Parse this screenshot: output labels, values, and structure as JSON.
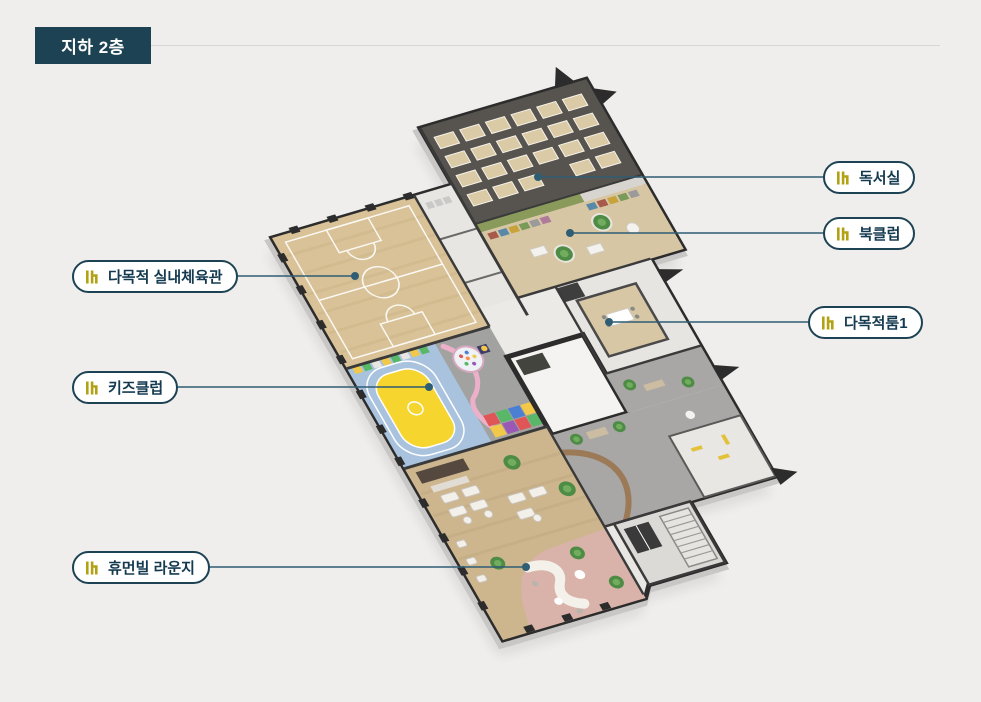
{
  "header": {
    "floor_badge": "지하 2층",
    "badge_color": "#1d4253"
  },
  "floorplan": {
    "type": "isometric-3d-floor-plan",
    "floor": "지하 2층",
    "callouts": [
      {
        "id": "reading-room",
        "label": "독서실",
        "side": "right"
      },
      {
        "id": "book-club",
        "label": "북클럽",
        "side": "right"
      },
      {
        "id": "multipurpose-gym",
        "label": "다목적 실내체육관",
        "side": "left"
      },
      {
        "id": "multipurpose-room-1",
        "label": "다목적룸1",
        "side": "right"
      },
      {
        "id": "kids-club",
        "label": "키즈클럽",
        "side": "left"
      },
      {
        "id": "humanville-lounge",
        "label": "휴먼빌 라운지",
        "side": "left"
      }
    ],
    "unlabeled_areas": [
      {
        "id": "lobby-corridor",
        "floor_color": "#a8a7a5"
      },
      {
        "id": "elevator-core",
        "floor_color": "#f4f3f1"
      },
      {
        "id": "stair-hall",
        "floor_color": "#dcdad7"
      },
      {
        "id": "entrance-area",
        "floor_color": "#e9e7e3"
      }
    ],
    "icon": {
      "name": "humanville-logo-icon",
      "color": "#b2a113"
    },
    "colors": {
      "background": "#efeeec",
      "callout_border": "#1d4253",
      "callout_text": "#143a50",
      "leader_line": "#2f5d74",
      "gym_wood": "#d9c298",
      "kids_blue": "#a9c3df",
      "track_yellow": "#f6d52e",
      "reading_floor": "#57544f",
      "bookclub_wood": "#d7c6a4",
      "green_wall": "#8a9a5a",
      "lounge_wood": "#cdb58e",
      "lounge_pink": "#d9b3a9",
      "wall_dark": "#2c2c2c"
    }
  }
}
